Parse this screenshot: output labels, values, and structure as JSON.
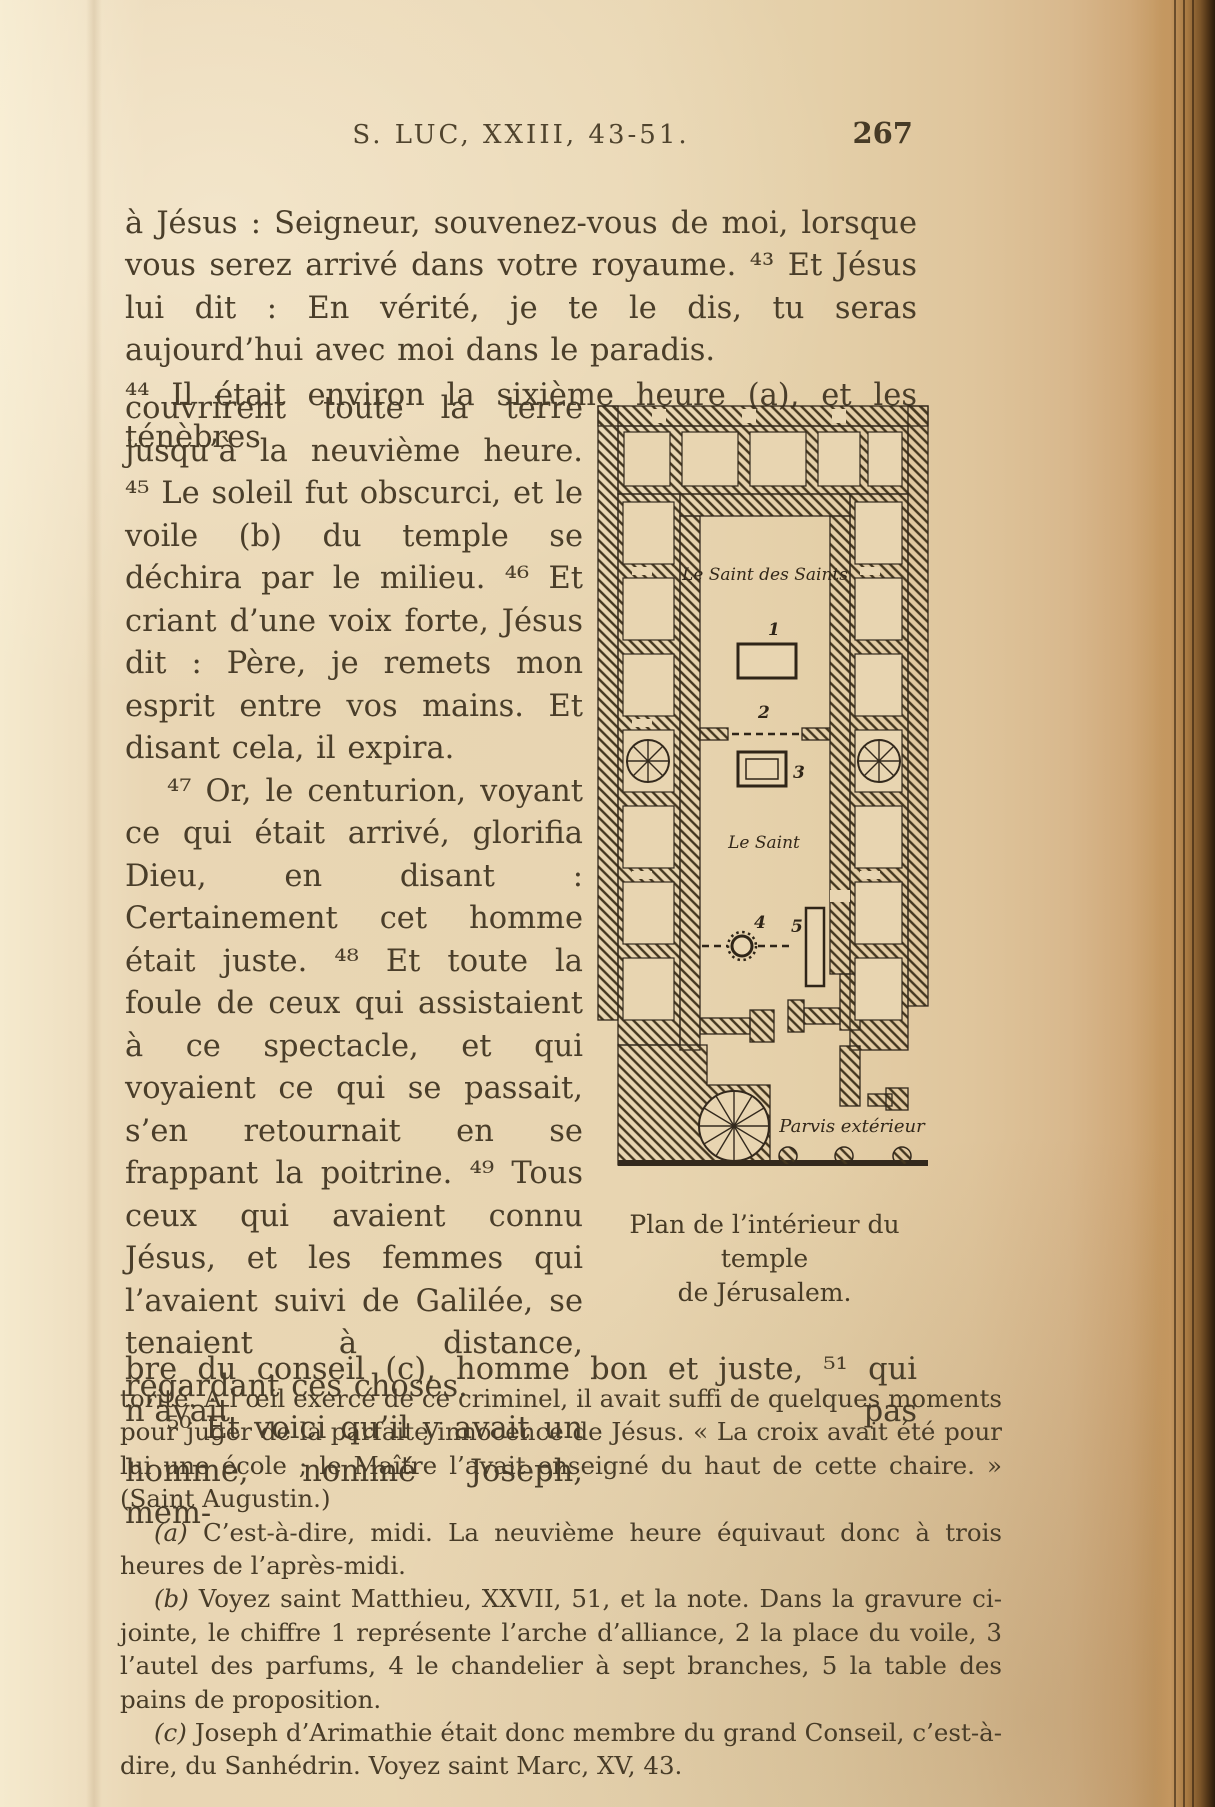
{
  "page": {
    "header": {
      "title": "S. LUC, XXIII, 43-51.",
      "page_number": "267"
    },
    "body": {
      "p1": "à Jésus : Seigneur, souvenez-vous de moi, lorsque vous serez arrivé dans votre royaume. ⁴³ Et Jésus lui dit : En vérité, je te le dis, tu seras aujourd’hui avec moi dans le paradis.",
      "p2_intro": "⁴⁴ Il était environ la sixième heure (a), et les ténèbres",
      "p2_rest": "couvrirent toute la terre jusqu’à la neuvième heure. ⁴⁵ Le soleil fut obscurci, et le voile (b) du temple se déchira par le milieu. ⁴⁶ Et criant d’une voix forte, Jésus dit : Père, je remets mon esprit entre vos mains. Et disant cela, il expira.",
      "p3": "⁴⁷ Or, le centurion, voyant ce qui était arrivé, glorifia Dieu, en disant : Certainement cet homme était juste. ⁴⁸ Et toute la foule de ceux qui assistaient à ce spectacle, et qui voyaient ce qui se passait, s’en retournait en se frappant la poitrine. ⁴⁹ Tous ceux qui avaient connu Jésus, et les femmes qui l’avaient suivi de Galilée, se tenaient à distance, regardant ces choses.",
      "p4_col": "⁵⁰ Et voici qu’il y avait un homme, nommé Joseph, mem-",
      "p4_full": "bre du conseil (c), homme bon et juste, ⁵¹ qui n’avait pas"
    },
    "figure": {
      "labels": {
        "holy_of_holies": "Le Saint des Saints",
        "holy_place": "Le Saint",
        "outer_court": "Parvis extérieur"
      },
      "numbers": {
        "ark": "1",
        "veil": "2",
        "altar": "3",
        "candlestick": "4",
        "table": "5"
      },
      "caption_line1": "Plan de l’intérieur du temple",
      "caption_line2": "de Jérusalem."
    },
    "footnotes": {
      "cont": "torité. A l’œil exercé de ce criminel, il avait suffi de quelques moments pour juger de la parfaite innocence de Jésus. « La croix avait été pour lui une école ; le Maître l’avait enseigné du haut de cette chaire. » (Saint Augustin.)",
      "a_label": "(a)",
      "a_text": "C’est-à-dire, midi. La neuvième heure équivaut donc à trois heures de l’après-midi.",
      "b_label": "(b)",
      "b_text": "Voyez saint Matthieu, XXVII, 51, et la note. Dans la gravure ci-jointe, le chiffre 1 représente l’arche d’alliance, 2 la place du voile, 3 l’autel des parfums, 4 le chandelier à sept branches, 5 la table des pains de proposition.",
      "c_label": "(c)",
      "c_text": "Joseph d’Arimathie était donc membre du grand Conseil, c’est-à-dire, du Sanhédrin. Voyez saint Marc, XV, 43."
    },
    "colors": {
      "paper": "#e8d5b1",
      "ink": "#4a3e2a",
      "figure_ink": "#33281a"
    }
  }
}
